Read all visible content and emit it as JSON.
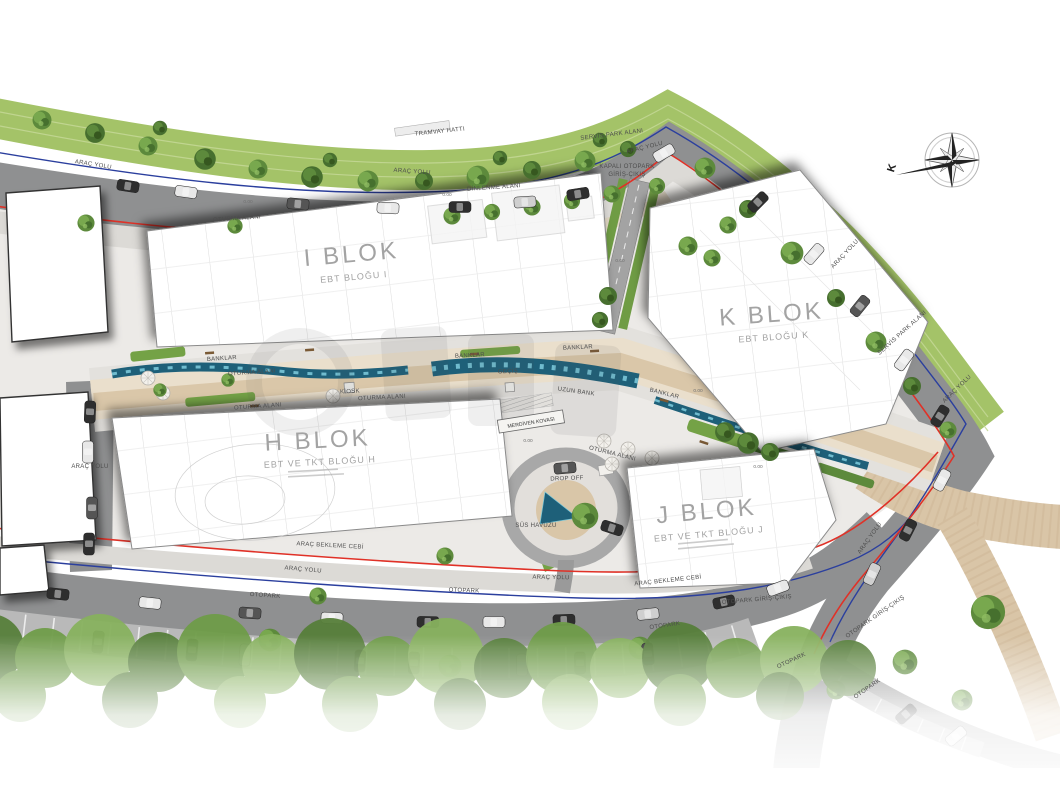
{
  "plan": {
    "blocks": [
      {
        "id": "i",
        "title": "I BLOK",
        "subtitle": "EBT BLOĞU I"
      },
      {
        "id": "k",
        "title": "K BLOK",
        "subtitle": "EBT BLOĞU K"
      },
      {
        "id": "h",
        "title": "H BLOK",
        "subtitle": "EBT VE TKT BLOĞU H"
      },
      {
        "id": "j",
        "title": "J BLOK",
        "subtitle": "EBT VE TKT BLOĞU J"
      }
    ],
    "labels": {
      "arac_yolu": "ARAÇ YOLU",
      "otopark": "OTOPARK",
      "arac_bekleme_cebi": "ARAÇ BEKLEME CEBİ",
      "servis_park_alani": "SERVİS PARK ALANI",
      "tramvay_hatti": "TRAMVAY HATTI",
      "kapali_otopark_line1": "KAPALI OTOPARK",
      "kapali_otopark_line2": "GİRİŞ-ÇIKIŞ",
      "otopark_giris_cikis": "OTOPARK GİRİŞ-ÇIKIŞ",
      "dinlenme_alani": "DİNLENME ALANI",
      "banklar": "BANKLAR",
      "oturma_alani": "OTURMA ALANI",
      "kiosk": "KİOSK",
      "gecis": "GEÇİŞ",
      "uzun_bank": "UZUN BANK",
      "merdiven_kovasi": "MERDİVEN KOVASI",
      "sus_havuzu": "SÜS HAVUZU",
      "drop_off": "DROP OFF",
      "elevation": "0.00",
      "north": "K"
    },
    "colors": {
      "tram_corridor": "#a4c368",
      "road": "#8f9091",
      "parking_lane": "#b9b9b9",
      "boundary_red": "#e03127",
      "boundary_blue": "#2b3f9e",
      "water": "#1e6079",
      "water_light": "#79c7d8",
      "walkway_beige": "#d9c5a7",
      "paving": "#eceae7",
      "tree_green": "#5d8a3c",
      "building": "#ffffff"
    }
  }
}
